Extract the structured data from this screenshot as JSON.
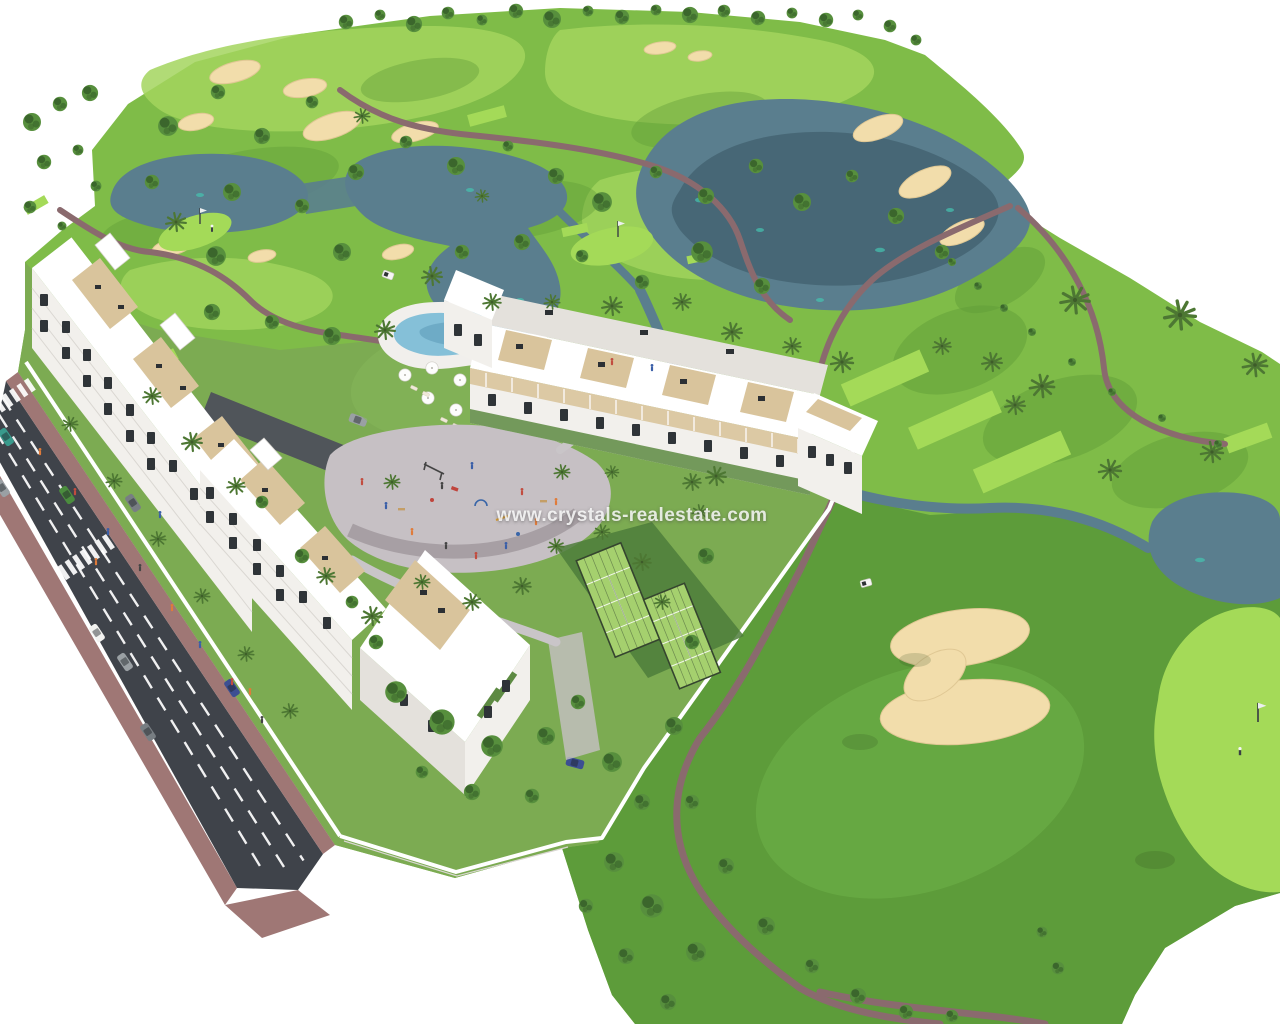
{
  "meta": {
    "type": "architectural-render",
    "description": "Aerial 3D rendering of a golf resort residential development: white apartment blocks with roof terraces beside a golf course with lakes, sand bunkers and cart paths; swimming pool with sun umbrellas, playground plaza, padel courts, perimeter walls, and a main road with crosswalks, cars and pedestrians."
  },
  "watermark": {
    "text": "www.crystals-realestate.com"
  },
  "scene": {
    "background": "#ffffff",
    "features": [
      "golf-course",
      "lakes",
      "sand-bunkers",
      "cart-paths",
      "apartment-buildings",
      "roof-terraces",
      "swimming-pool",
      "sun-umbrellas",
      "playground-plaza",
      "padel-courts",
      "gardens",
      "perimeter-wall",
      "road",
      "sidewalks",
      "crosswalks",
      "cars",
      "pedestrians",
      "golf-cart",
      "putting-greens",
      "flags",
      "golfer",
      "palm-trees",
      "trees"
    ],
    "counts": {
      "apartment-blocks": 3,
      "padel-courts": 2,
      "crosswalks": 2,
      "road-lanes": 4
    }
  },
  "palette": {
    "bg": "#ffffff",
    "grass-base": "#7fbc48",
    "grass-light": "#a3d55e",
    "grass-dark": "#5f9c38",
    "grass-right": "#5d9c3a",
    "grass-right-light": "#6fb34a",
    "grass-bright": "#a4da58",
    "lawn": "#7cab52",
    "tree-mid": "#578f3d",
    "tree-dark": "#3b662c",
    "palm": "#4d7733",
    "water": "#5a7e8e",
    "water-deep": "#42606e",
    "water-teal": "#45c4b0",
    "sand": "#f2ddab",
    "sand-edge": "#e0c894",
    "path": "#8a6a6e",
    "path-light": "#c9c5c8",
    "road": "#3f434a",
    "sidewalk": "#9f7775",
    "driveway": "#50555a",
    "building": "#ffffff",
    "facade": "#f2f0ec",
    "facade-shade": "#e4e1dc",
    "window": "#2f3438",
    "wood": "#c49e66",
    "wood-light": "#d9c49c",
    "pool": "#85c0d8",
    "pool-deep": "#5f9cba",
    "deck": "#f1efec",
    "plaza": "#c6c0c4",
    "plaza-dark": "#a79fa4",
    "court": "#a5d06e",
    "fence": "#35452f",
    "wall": "#ffffff",
    "hedge": "#5d8a42",
    "car-white": "#f2f2f0",
    "car-gray": "#9aa0a4",
    "car-gray-dark": "#787e83",
    "car-blue": "#3c4f92",
    "car-green": "#4b8c3e",
    "car-teal": "#399a8c",
    "people-orange": "#e07b3a",
    "people-red": "#c24c3f",
    "people-blue": "#3a5fa8",
    "people-dark": "#444444"
  }
}
